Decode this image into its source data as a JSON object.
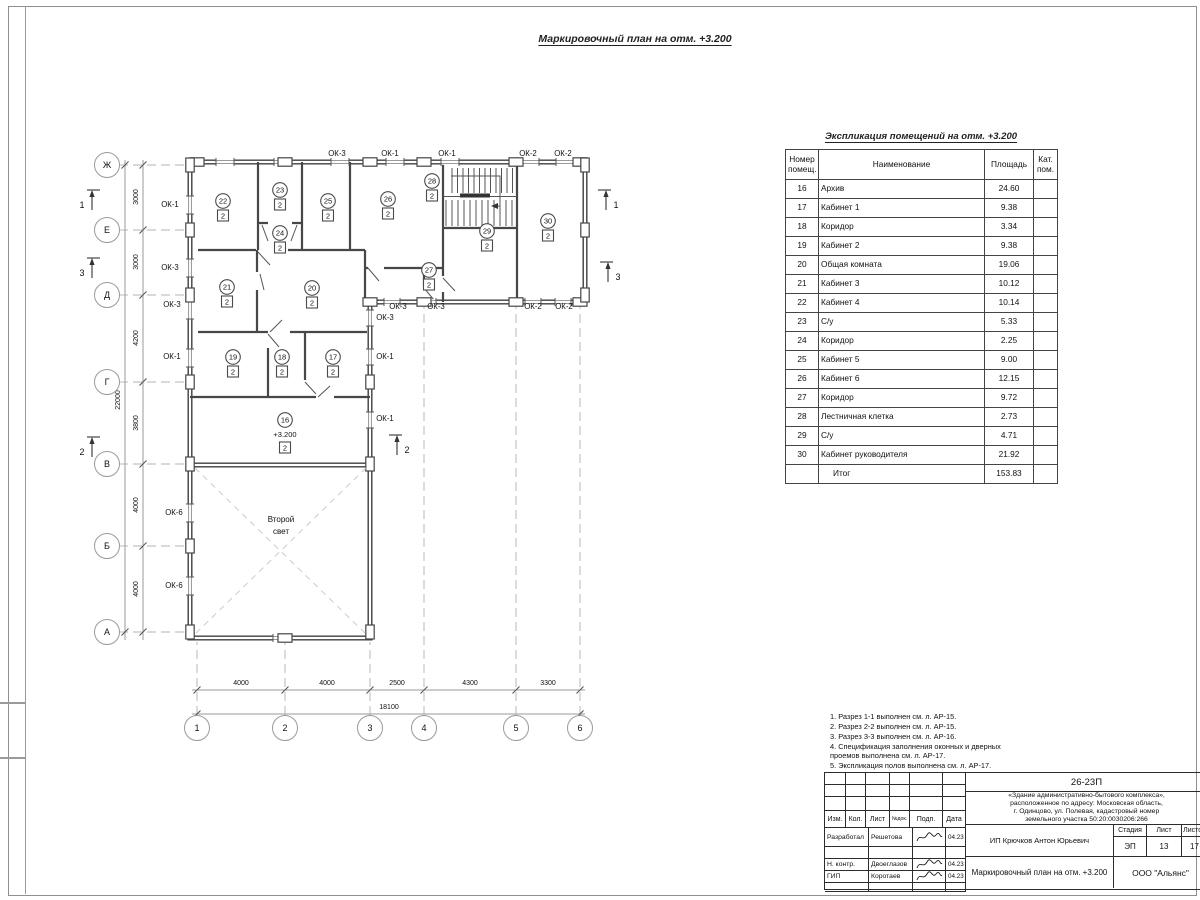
{
  "sheet": {
    "plan_title": "Маркировочный план на отм. +3.200",
    "table_title": "Экспликация помещений на отм. +3.200"
  },
  "table": {
    "headers": {
      "num": "Номер помещ.",
      "name": "Наименование",
      "area": "Площадь",
      "cat": "Кат. пом."
    },
    "rows": [
      [
        "16",
        "Архив",
        "24.60"
      ],
      [
        "17",
        "Кабинет 1",
        "9.38"
      ],
      [
        "18",
        "Коридор",
        "3.34"
      ],
      [
        "19",
        "Кабинет 2",
        "9.38"
      ],
      [
        "20",
        "Общая комната",
        "19.06"
      ],
      [
        "21",
        "Кабинет 3",
        "10.12"
      ],
      [
        "22",
        "Кабинет 4",
        "10.14"
      ],
      [
        "23",
        "С/у",
        "5.33"
      ],
      [
        "24",
        "Коридор",
        "2.25"
      ],
      [
        "25",
        "Кабинет 5",
        "9.00"
      ],
      [
        "26",
        "Кабинет 6",
        "12.15"
      ],
      [
        "27",
        "Коридор",
        "9.72"
      ],
      [
        "28",
        "Лестничная клетка",
        "2.73"
      ],
      [
        "29",
        "С/у",
        "4.71"
      ],
      [
        "30",
        "Кабинет руководителя",
        "21.92"
      ]
    ],
    "total_label": "Итог",
    "total_value": "153.83"
  },
  "notes_lines": [
    "1. Разрез 1-1 выполнен см. л. АР-15.",
    "2. Разрез 2-2 выполнен см. л. АР-15.",
    "3. Разрез 3-3 выполнен см. л. АР-16.",
    "4. Спецификация заполнения оконных и дверных",
    "    проемов выполнена см. л. АР-17.",
    "5. Экспликация полов выполнена см. л. АР-17."
  ],
  "plan": {
    "second_light_lines": [
      "Второй",
      "свет"
    ],
    "room_markers": [
      {
        "n": "22",
        "cat": "2",
        "x": 223,
        "y": 201
      },
      {
        "n": "23",
        "cat": "2",
        "x": 280,
        "y": 190
      },
      {
        "n": "24",
        "cat": "2",
        "x": 280,
        "y": 233
      },
      {
        "n": "25",
        "cat": "2",
        "x": 328,
        "y": 201
      },
      {
        "n": "26",
        "cat": "2",
        "x": 388,
        "y": 199
      },
      {
        "n": "28",
        "cat": "2",
        "x": 432,
        "y": 181
      },
      {
        "n": "29",
        "cat": "2",
        "x": 487,
        "y": 231
      },
      {
        "n": "30",
        "cat": "2",
        "x": 548,
        "y": 221
      },
      {
        "n": "27",
        "cat": "2",
        "x": 429,
        "y": 270
      },
      {
        "n": "21",
        "cat": "2",
        "x": 227,
        "y": 287
      },
      {
        "n": "20",
        "cat": "2",
        "x": 312,
        "y": 288
      },
      {
        "n": "19",
        "cat": "2",
        "x": 233,
        "y": 357
      },
      {
        "n": "18",
        "cat": "2",
        "x": 282,
        "y": 357
      },
      {
        "n": "17",
        "cat": "2",
        "x": 333,
        "y": 357
      },
      {
        "n": "16",
        "cat": "2",
        "x": 285,
        "y": 420,
        "level": "+3.200"
      }
    ],
    "window_labels": [
      {
        "t": "ОК-3",
        "x": 337,
        "y": 156
      },
      {
        "t": "ОК-1",
        "x": 390,
        "y": 156
      },
      {
        "t": "ОК-1",
        "x": 447,
        "y": 156
      },
      {
        "t": "ОК-2",
        "x": 528,
        "y": 156
      },
      {
        "t": "ОК-2",
        "x": 563,
        "y": 156
      },
      {
        "t": "ОК-1",
        "x": 170,
        "y": 207
      },
      {
        "t": "ОК-3",
        "x": 170,
        "y": 270
      },
      {
        "t": "ОК-3",
        "x": 172,
        "y": 307
      },
      {
        "t": "ОК-1",
        "x": 172,
        "y": 359
      },
      {
        "t": "ОК-6",
        "x": 174,
        "y": 515
      },
      {
        "t": "ОК-6",
        "x": 174,
        "y": 588
      },
      {
        "t": "ОК-3",
        "x": 398,
        "y": 309
      },
      {
        "t": "ОК-3",
        "x": 436,
        "y": 309
      },
      {
        "t": "ОК-2",
        "x": 533,
        "y": 309
      },
      {
        "t": "ОК-2",
        "x": 564,
        "y": 309
      },
      {
        "t": "ОК-3",
        "x": 385,
        "y": 320
      },
      {
        "t": "ОК-1",
        "x": 385,
        "y": 359
      },
      {
        "t": "ОК-1",
        "x": 385,
        "y": 421
      }
    ],
    "axis_rows": [
      {
        "label": "Ж",
        "y": 165
      },
      {
        "label": "Е",
        "y": 230
      },
      {
        "label": "Д",
        "y": 295
      },
      {
        "label": "Г",
        "y": 382
      },
      {
        "label": "В",
        "y": 464
      },
      {
        "label": "Б",
        "y": 546
      },
      {
        "label": "А",
        "y": 632
      }
    ],
    "axis_cols": [
      {
        "label": "1",
        "x": 197
      },
      {
        "label": "2",
        "x": 285
      },
      {
        "label": "3",
        "x": 370
      },
      {
        "label": "4",
        "x": 424
      },
      {
        "label": "5",
        "x": 516
      },
      {
        "label": "6",
        "x": 580
      }
    ],
    "dims_left": [
      {
        "t": "3000",
        "y": 197
      },
      {
        "t": "3000",
        "y": 262
      },
      {
        "t": "4200",
        "y": 338
      },
      {
        "t": "3800",
        "y": 423
      },
      {
        "t": "4000",
        "y": 505
      },
      {
        "t": "4000",
        "y": 589
      }
    ],
    "dim_total_left": "22000",
    "dims_bottom": [
      {
        "t": "4000",
        "x": 241
      },
      {
        "t": "4000",
        "x": 327
      },
      {
        "t": "2500",
        "x": 397
      },
      {
        "t": "4300",
        "x": 470
      },
      {
        "t": "3300",
        "x": 548
      }
    ],
    "dim_total_bottom": "18100",
    "section_markers": [
      {
        "n": "1",
        "x": 92,
        "y": 200,
        "side": "L"
      },
      {
        "n": "3",
        "x": 92,
        "y": 268,
        "side": "L"
      },
      {
        "n": "2",
        "x": 92,
        "y": 447,
        "side": "L"
      },
      {
        "n": "1",
        "x": 606,
        "y": 200,
        "side": "R"
      },
      {
        "n": "3",
        "x": 608,
        "y": 272,
        "side": "R"
      },
      {
        "n": "2",
        "x": 397,
        "y": 445,
        "side": "R"
      }
    ]
  },
  "titleblock": {
    "code": "26-23П",
    "desc_lines": [
      "«Здание административно-бытового комплекса»,",
      "расположенное по адресу: Московская область,",
      "г. Одинцово, ул. Полевая, кадастровый номер",
      "земельного участка 50:20:0030206:266"
    ],
    "header_cols": [
      "Изм.",
      "Кол.",
      "Лист",
      "№док.",
      "Подп.",
      "Дата"
    ],
    "sig_rows": [
      {
        "role": "Разработал",
        "name": "Решетова",
        "date": "04.23"
      },
      {
        "role": "Н. контр.",
        "name": "Двоеглазов",
        "date": "04.23"
      },
      {
        "role": "ГИП",
        "name": "Коротаев",
        "date": "04.23"
      }
    ],
    "client": "ИП Крючков Антон Юрьевич",
    "stage_label": "Стадия",
    "sheet_label": "Лист",
    "sheets_label": "Листов",
    "stage": "ЭП",
    "sheet_no": "13",
    "sheets_total": "17",
    "doc_title": "Маркировочный план на отм. +3.200",
    "company": "ООО \"Альянс\""
  }
}
